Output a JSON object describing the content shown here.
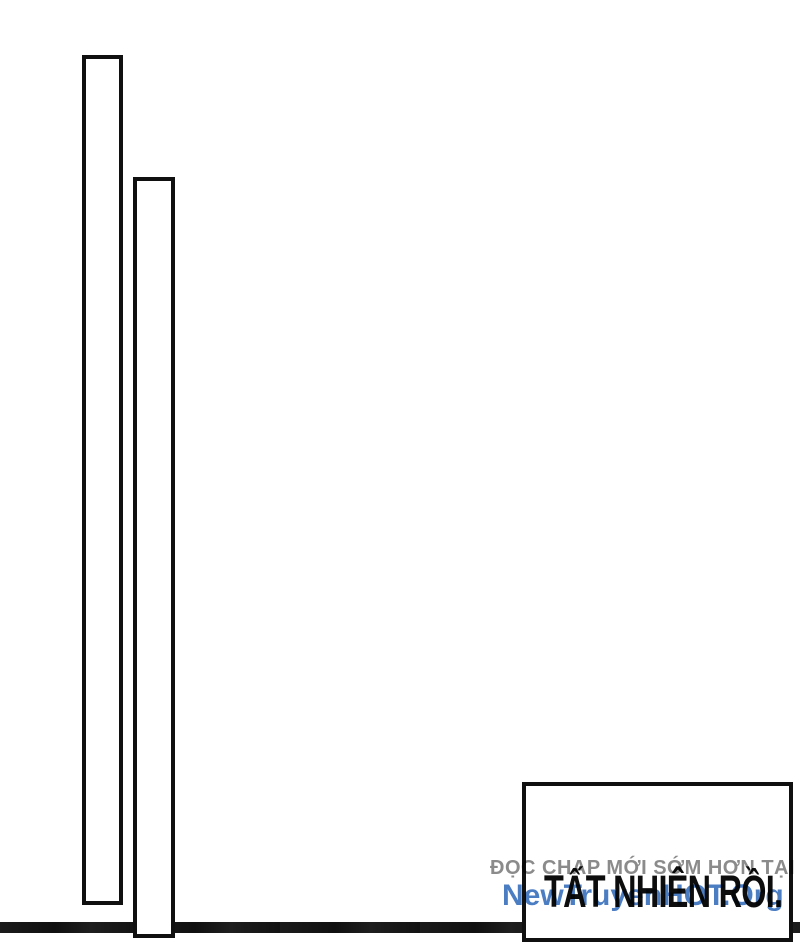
{
  "colors": {
    "background": "#ffffff",
    "line_art": "#101010",
    "caption_text": "#0d0d0d",
    "watermark_gray": "#8b8b8b",
    "watermark_blue": "#4b7dc3",
    "bottom_strip": "#151515"
  },
  "caption": {
    "text": "TẤT NHIÊN RỒI."
  },
  "watermark": {
    "line1": "ĐỌC CHAP MỚI SỚM HƠN TẠI",
    "line2": "NewTruyenHOT.Org"
  }
}
